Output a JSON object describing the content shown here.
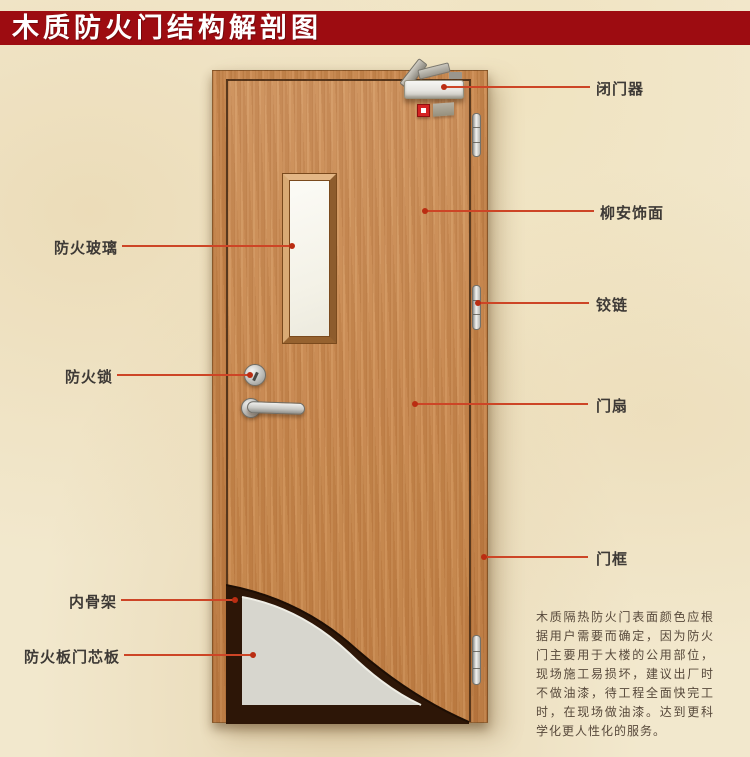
{
  "title": "木质防火门结构解剖图",
  "labels": {
    "fire_glass": "防火玻璃",
    "fire_lock": "防火锁",
    "inner_skeleton": "内骨架",
    "fire_board_core": "防火板门芯板",
    "door_closer": "闭门器",
    "lauan_veneer": "柳安饰面",
    "hinge": "铰链",
    "door_leaf": "门扇",
    "door_frame": "门框"
  },
  "description": "木质隔热防火门表面颜色应根据用户需要而确定，因为防火门主要用于大楼的公用部位，现场施工易损坏，建议出厂时不做油漆，待工程全面快完工时，在现场做油漆。达到更科学化更人性化的服务。",
  "colors": {
    "banner": "#9d0c11",
    "annotation_line": "#cd4526",
    "wood": "#c8884f",
    "core_panel": "#d7d6ce",
    "skeleton": "#2d1607",
    "background": "#f2e8cd"
  }
}
